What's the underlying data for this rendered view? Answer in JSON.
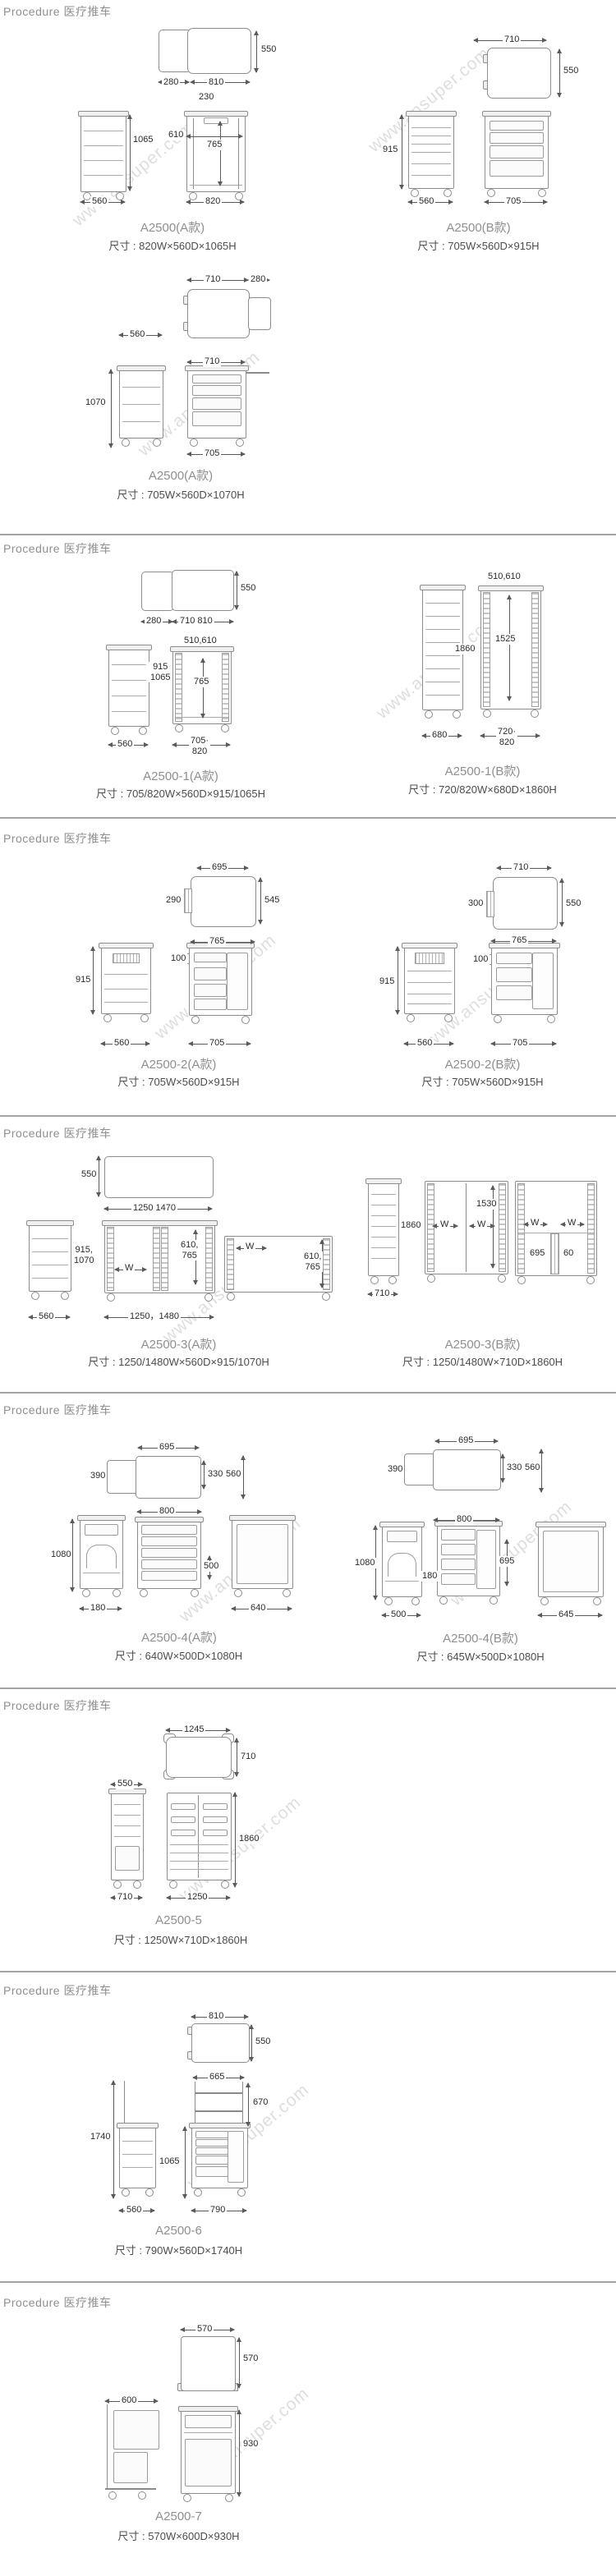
{
  "watermark": "www.ansuper.com",
  "sections": [
    {
      "header": "Procedure 医疗推车",
      "groups": [
        {
          "model": "A2500(A款)",
          "size": "尺寸 : 820W×560D×1065H",
          "dims": [
            "280",
            "810",
            "550",
            "230",
            "1065",
            "560",
            "610",
            "765",
            "820"
          ]
        },
        {
          "model": "A2500(B款)",
          "size": "尺寸 : 705W×560D×915H",
          "dims": [
            "710",
            "550",
            "915",
            "560",
            "705"
          ]
        },
        {
          "model": "A2500(A款)",
          "size": "尺寸 : 705W×560D×1070H",
          "dims": [
            "710",
            "280",
            "560",
            "1070",
            "710",
            "705"
          ]
        }
      ]
    },
    {
      "header": "Procedure 医疗推车",
      "groups": [
        {
          "model": "A2500-1(A款)",
          "size": "尺寸 : 705/820W×560D×915/1065H",
          "dims": [
            "280",
            "710 810",
            "550",
            "510,610",
            "915\n1065",
            "765",
            "560",
            "705·\n820"
          ]
        },
        {
          "model": "A2500-1(B款)",
          "size": "尺寸 : 720/820W×680D×1860H",
          "dims": [
            "510,610",
            "1860",
            "1525",
            "680",
            "720·\n820"
          ]
        }
      ]
    },
    {
      "header": "Procedure 医疗推车",
      "groups": [
        {
          "model": "A2500-2(A款)",
          "size": "尺寸 : 705W×560D×915H",
          "dims": [
            "695",
            "290",
            "545",
            "765",
            "100",
            "915",
            "560",
            "705"
          ]
        },
        {
          "model": "A2500-2(B款)",
          "size": "尺寸 : 705W×560D×915H",
          "dims": [
            "710",
            "300",
            "550",
            "765",
            "100",
            "915",
            "560",
            "705"
          ]
        }
      ]
    },
    {
      "header": "Procedure 医疗推车",
      "groups": [
        {
          "model": "A2500-3(A款)",
          "size": "尺寸 : 1250/1480W×560D×915/1070H",
          "dims": [
            "550",
            "1250 1470",
            "915,\n1070",
            "560",
            "W",
            "610,\n765",
            "1250，1480",
            "W",
            "610,\n765"
          ]
        },
        {
          "model": "A2500-3(B款)",
          "size": "尺寸 : 1250/1480W×710D×1860H",
          "dims": [
            "1860",
            "710",
            "1530",
            "W",
            "W",
            "W",
            "W",
            "695",
            "60"
          ]
        }
      ]
    },
    {
      "header": "Procedure 医疗推车",
      "groups": [
        {
          "model": "A2500-4(A款)",
          "size": "尺寸 : 640W×500D×1080H",
          "dims": [
            "695",
            "390",
            "330",
            "560",
            "800",
            "1080",
            "180",
            "500",
            "640"
          ]
        },
        {
          "model": "A2500-4(B款)",
          "size": "尺寸 : 645W×500D×1080H",
          "dims": [
            "695",
            "390",
            "330",
            "560",
            "800",
            "1080",
            "180",
            "695",
            "500",
            "645"
          ]
        }
      ]
    },
    {
      "header": "Procedure 医疗推车",
      "groups": [
        {
          "model": "A2500-5",
          "size": "尺寸 : 1250W×710D×1860H",
          "dims": [
            "1245",
            "710",
            "550",
            "1860",
            "710",
            "1250"
          ]
        }
      ]
    },
    {
      "header": "Procedure 医疗推车",
      "groups": [
        {
          "model": "A2500-6",
          "size": "尺寸 : 790W×560D×1740H",
          "dims": [
            "810",
            "550",
            "665",
            "1740",
            "560",
            "670",
            "1065",
            "790"
          ]
        }
      ]
    },
    {
      "header": "Procedure 医疗推车",
      "groups": [
        {
          "model": "A2500-7",
          "size": "尺寸 : 570W×600D×930H",
          "dims": [
            "570",
            "570",
            "600",
            "930"
          ]
        }
      ]
    }
  ]
}
